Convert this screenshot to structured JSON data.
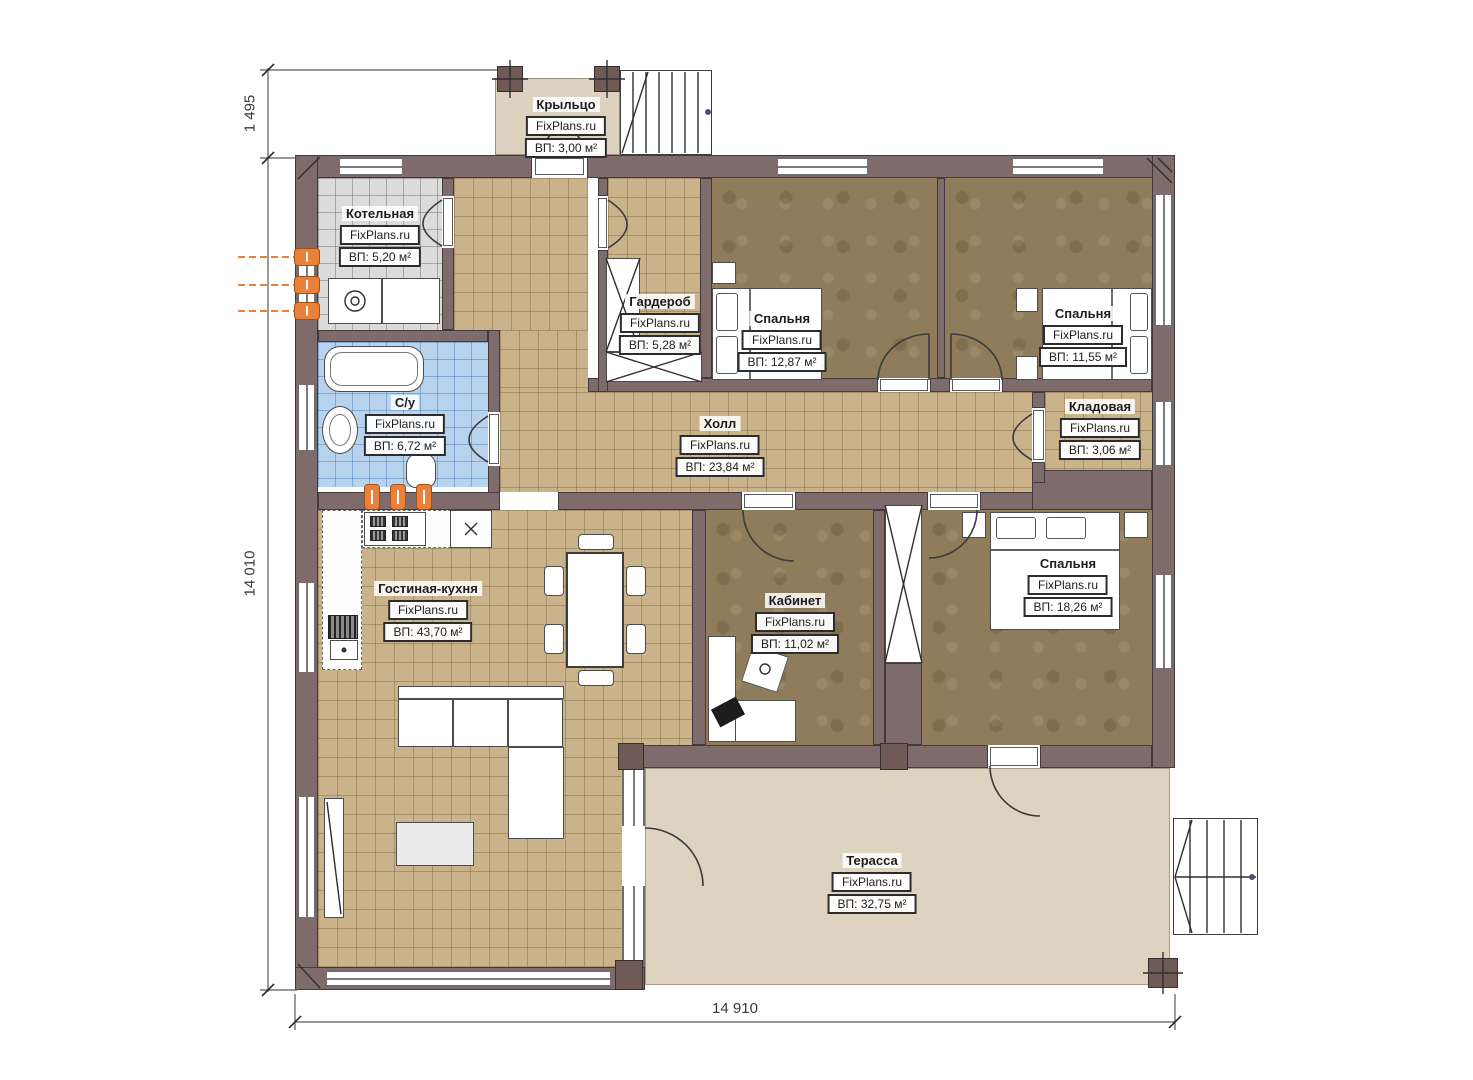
{
  "branding": {
    "site": "FixPlans.ru"
  },
  "dimensions": {
    "top_left_height": "1 495",
    "left_height": "14 010",
    "bottom_width": "14 910"
  },
  "rooms": [
    {
      "id": "porch",
      "name": "Крыльцо",
      "area": "ВП: 3,00 м²"
    },
    {
      "id": "boiler",
      "name": "Котельная",
      "area": "ВП: 5,20 м²"
    },
    {
      "id": "wardrobe",
      "name": "Гардероб",
      "area": "ВП: 5,28 м²"
    },
    {
      "id": "bedroom-1",
      "name": "Спальня",
      "area": "ВП: 12,87 м²"
    },
    {
      "id": "bedroom-2",
      "name": "Спальня",
      "area": "ВП: 11,55 м²"
    },
    {
      "id": "bathroom",
      "name": "С/у",
      "area": "ВП: 6,72 м²"
    },
    {
      "id": "hall",
      "name": "Холл",
      "area": "ВП: 23,84 м²"
    },
    {
      "id": "storage",
      "name": "Кладовая",
      "area": "ВП: 3,06 м²"
    },
    {
      "id": "living-kitchen",
      "name": "Гостиная-кухня",
      "area": "ВП: 43,70 м²"
    },
    {
      "id": "office",
      "name": "Кабинет",
      "area": "ВП: 11,02 м²"
    },
    {
      "id": "bedroom-3",
      "name": "Спальня",
      "area": "ВП: 18,26 м²"
    },
    {
      "id": "terrace",
      "name": "Терасса",
      "area": "ВП: 32,75 м²"
    }
  ],
  "colors": {
    "wall": "#7e6c6d",
    "floor_tile_tan": "#cab38b",
    "floor_bedroom_brown": "#8e7c5a",
    "floor_boiler_gray": "#dbdbdb",
    "floor_bath_blue": "#b7d3ee",
    "floor_terrace": "#ded3c1",
    "heating_orange": "#e8823a"
  }
}
